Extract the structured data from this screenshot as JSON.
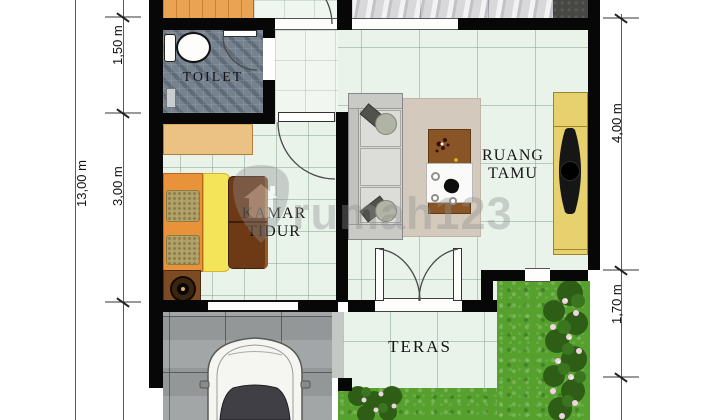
{
  "type": "house-floor-plan",
  "watermark": {
    "text": "rumah123",
    "logo": "rumah123-shield-house-logo"
  },
  "rooms": {
    "toilet": {
      "label": "TOILET"
    },
    "bedroom": {
      "line1": "KAMAR",
      "line2": "TIDUR"
    },
    "living": {
      "line1": "RUANG",
      "line2": "TAMU"
    },
    "terrace": {
      "label": "TERAS"
    }
  },
  "dimensions": {
    "overall": "13,00 m",
    "toilet": "1,50 m",
    "bedroom": "3,00 m",
    "living": "4,00 m",
    "terrace": "1,70 m"
  },
  "colors": {
    "wall": "#070707",
    "tile_mint": "#E9F3EA",
    "toilet_tile": "#77828F",
    "grass": "#56A02E",
    "carport": "#9DA0A0",
    "bed_frame_orange": "#E8923A",
    "bed_blanket_yellow": "#F4E459",
    "bed_panel_brown": "#6E3A16",
    "console_yellow": "#E7D16E",
    "rug_beige": "#D3CABD"
  }
}
